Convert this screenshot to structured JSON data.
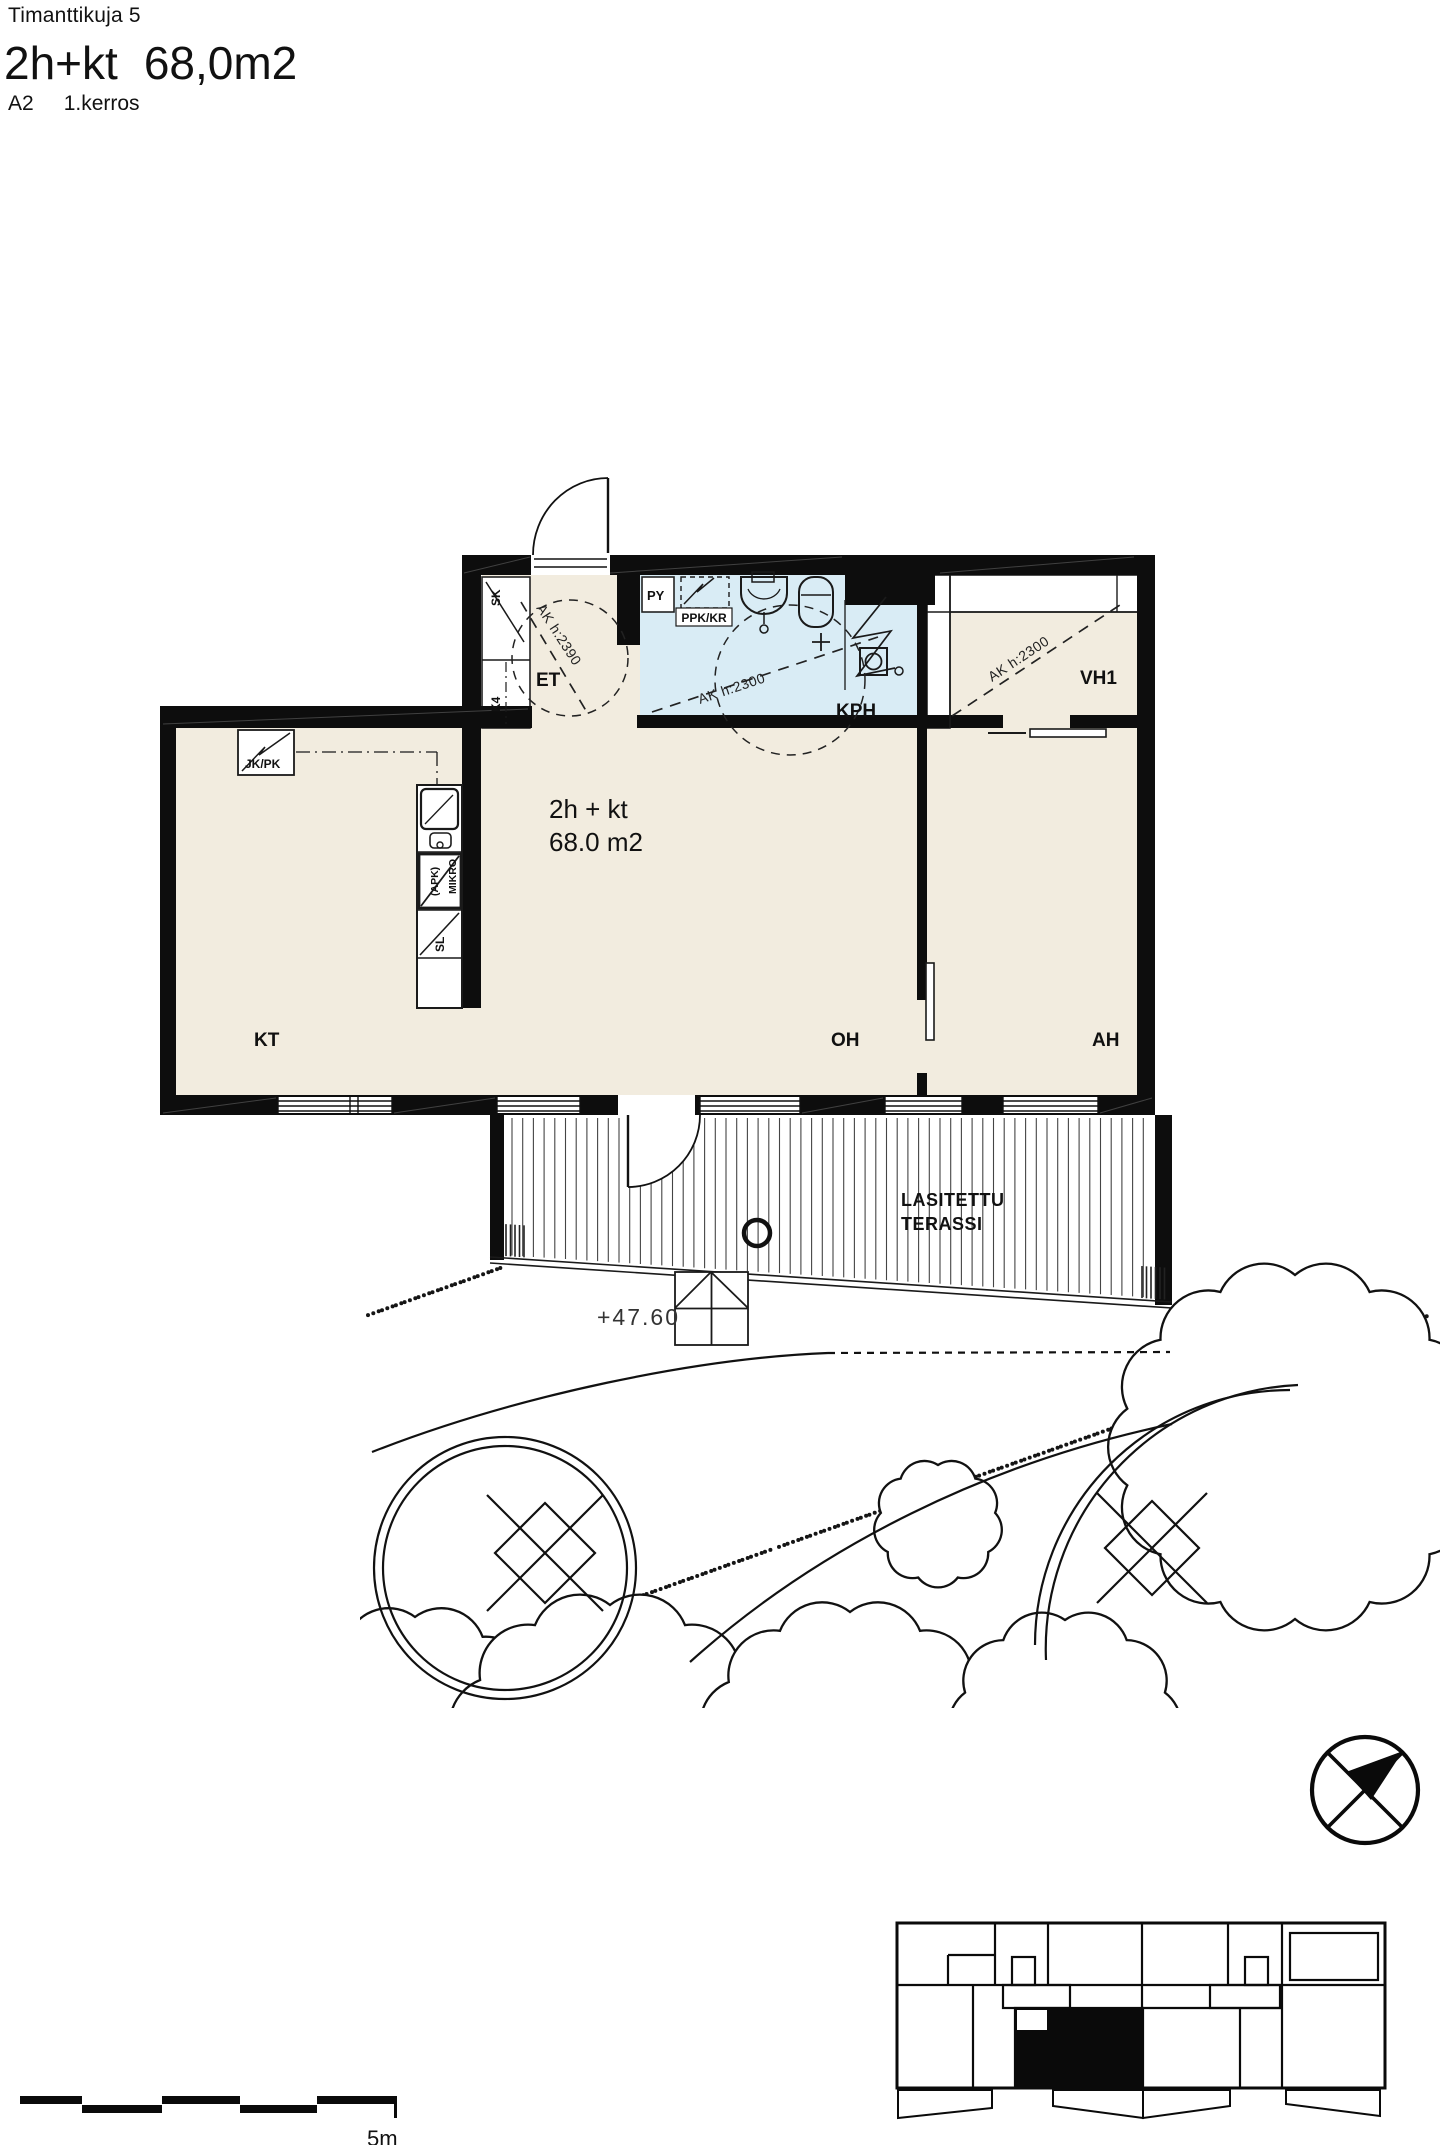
{
  "header": {
    "street": "Timanttikuja 5",
    "type": "2h+kt",
    "area": "68,0m2",
    "unit": "A2",
    "floor": "1.kerros"
  },
  "plan": {
    "area_text": {
      "line1": "2h + kt",
      "line2": "68.0 m2"
    },
    "rooms": {
      "et": "ET",
      "kph": "KPH",
      "vh1": "VH1",
      "kt": "KT",
      "oh": "OH",
      "ah": "AH"
    },
    "closets": {
      "sk": "SK",
      "k4": "K4",
      "py": "PY",
      "ppk_kr": "PPK/KR",
      "jk_pk": "JK/PK"
    },
    "kitchen": {
      "mikro": "MIKRO",
      "apk": "(APK)",
      "sl": "SL"
    },
    "ceiling_heights": {
      "et": "AK h:2390",
      "kph": "AK h:2300",
      "vh1": "AK h:2300"
    },
    "terrace": {
      "line1": "LASITETTU",
      "line2": "TERASSI"
    },
    "site": {
      "elevation": "+47.60"
    },
    "scalebar": {
      "label": "5m"
    },
    "colors": {
      "floor": "#f2ecdf",
      "bathroom": "#d9ecf5",
      "wall": "#0d0d0d"
    }
  }
}
